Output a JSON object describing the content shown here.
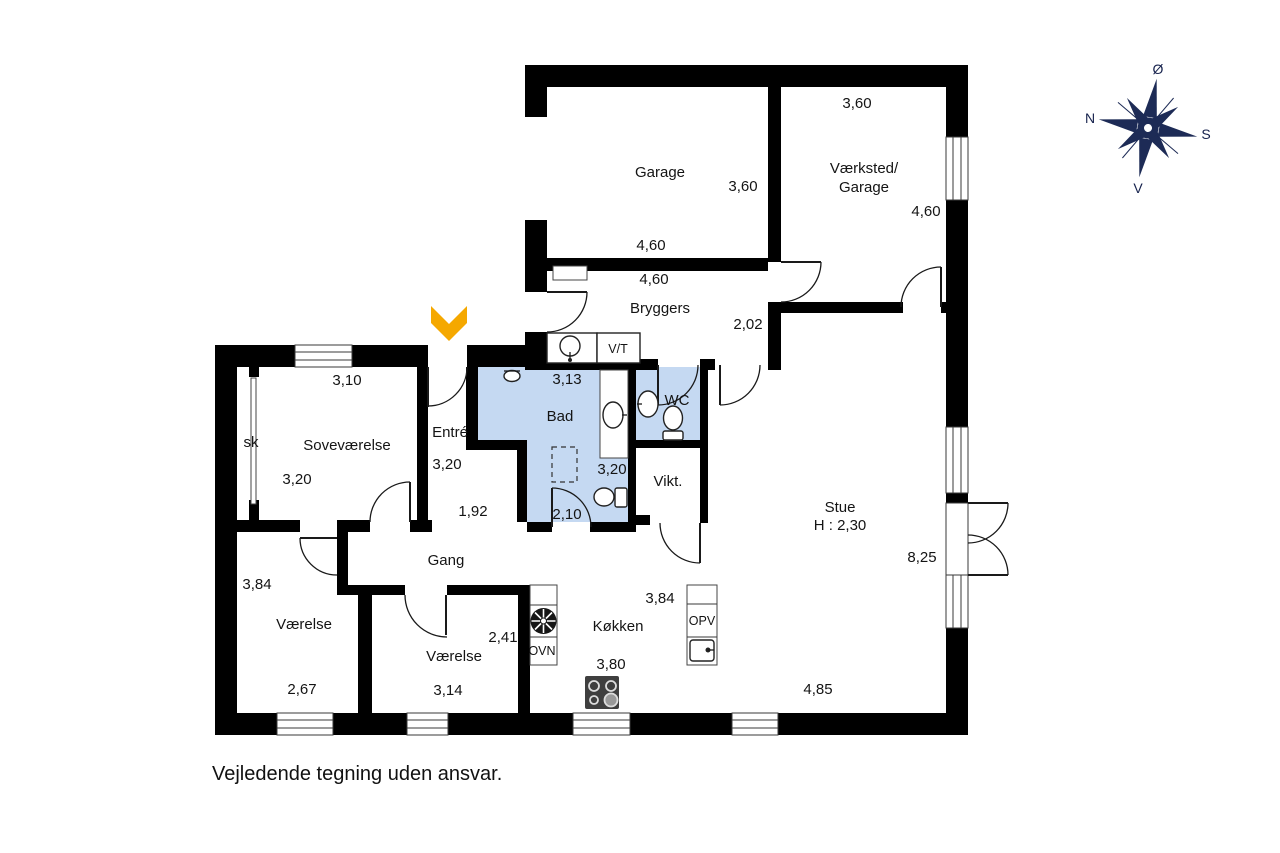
{
  "plan": {
    "garage": {
      "name": "Garage",
      "width": "3,60",
      "length": "4,60"
    },
    "vaerksted": {
      "name_line1": "Værksted/",
      "name_line2": "Garage",
      "width": "3,60",
      "length": "4,60"
    },
    "bryggers": {
      "name": "Bryggers",
      "length": "4,60",
      "width": "2,02"
    },
    "vt_label": "V/T",
    "bad": {
      "name": "Bad",
      "dim_top": "3,13",
      "dim_mid": "3,20",
      "dim_bottom": "2,10"
    },
    "wc": {
      "name": "WC"
    },
    "vikt": {
      "name": "Vikt."
    },
    "entre": {
      "name": "Entré",
      "dim1": "3,20",
      "dim2": "1,92"
    },
    "sk": {
      "name": "sk"
    },
    "sovevaerelse": {
      "name": "Soveværelse",
      "width": "3,10",
      "length": "3,20"
    },
    "gang": {
      "name": "Gang"
    },
    "vaerelse_left": {
      "name": "Værelse",
      "length": "3,84",
      "width": "2,67"
    },
    "vaerelse_right": {
      "name": "Værelse",
      "width": "2,41",
      "length": "3,14"
    },
    "koekken": {
      "name": "Køkken",
      "width": "3,84",
      "length": "3,80",
      "ovn_label": "OVN",
      "opv_label": "OPV"
    },
    "stue": {
      "name": "Stue",
      "ceiling_height": "H : 2,30",
      "length": "8,25",
      "width": "4,85"
    }
  },
  "compass": {
    "north": "N",
    "south": "S",
    "east": "Ø",
    "west": "V"
  },
  "disclaimer": "Vejledende tegning uden ansvar.",
  "colors": {
    "walls": "#000000",
    "wet_room_fill": "#c5d9f2",
    "entrance_arrow": "#f5a800",
    "compass": "#1d2b56"
  }
}
